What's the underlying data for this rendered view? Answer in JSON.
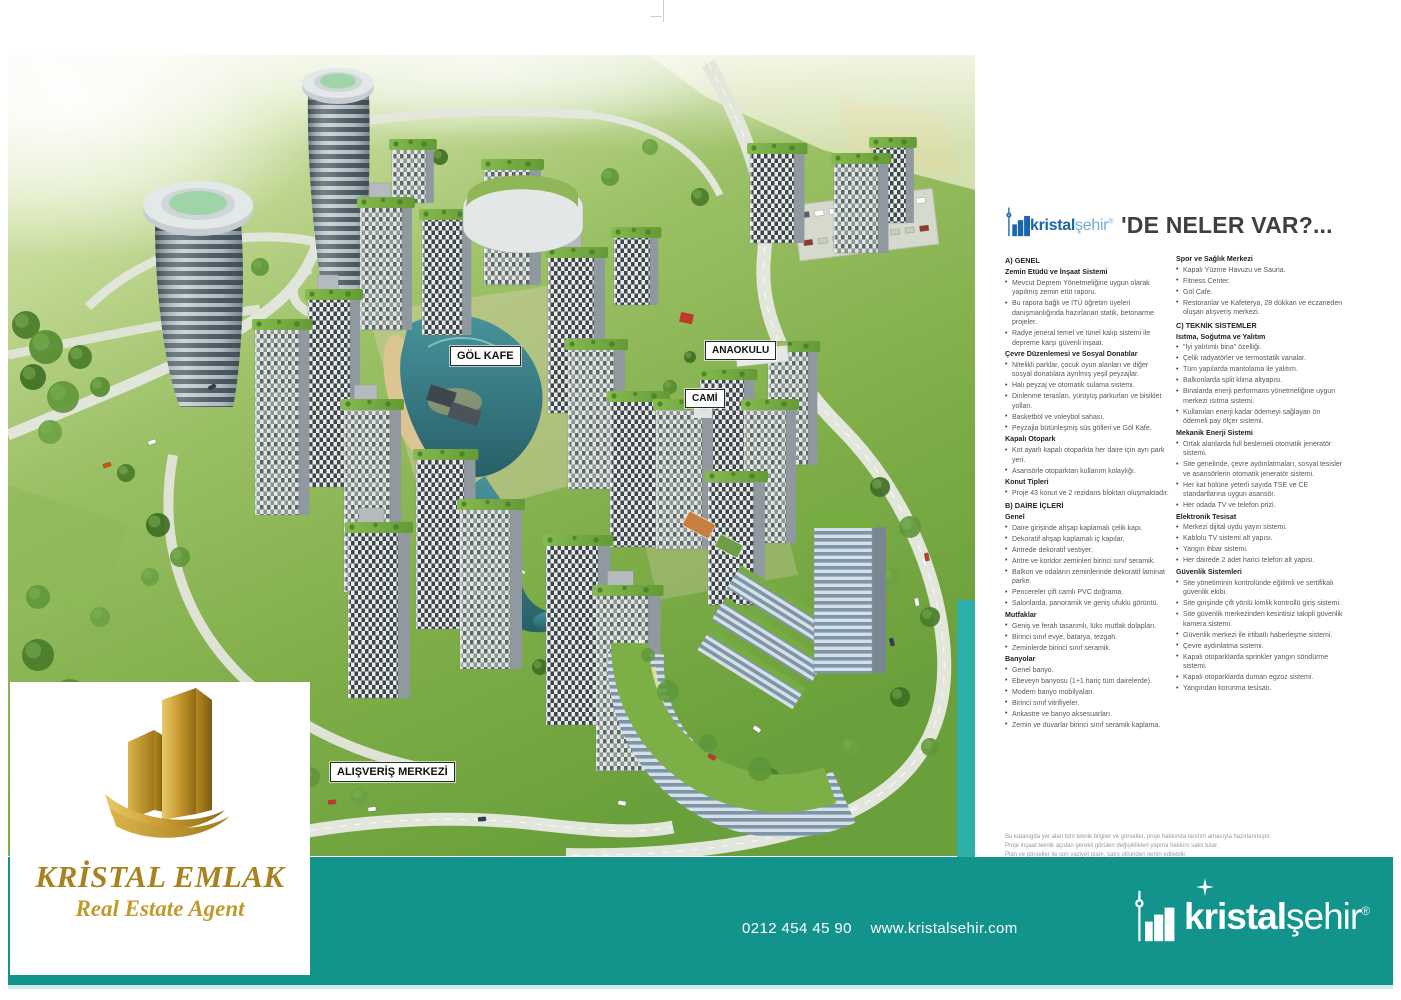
{
  "header": {
    "brand_bold": "kristal",
    "brand_light": "şehir",
    "reg": "®",
    "title": "'DE NELER VAR?..."
  },
  "map_labels": {
    "gol_kafe": "GÖL KAFE",
    "anaokulu": "ANAOKULU",
    "cami": "CAMİ",
    "avm": "ALIŞVERİŞ MERKEZİ"
  },
  "panel": {
    "columns": [
      {
        "sections": [
          {
            "heading": "A) GENEL",
            "kind": "maj",
            "bullets": []
          },
          {
            "heading": "Zemin Etüdü ve İnşaat Sistemi",
            "kind": "sub",
            "bullets": [
              "Mevcut Deprem Yönetmeliğine uygun olarak yapılmış zemin etüt raporu.",
              "Bu rapora bağlı ve İTÜ öğretim üyeleri danışmanlığında hazırlanan statik, betonarme projeler.",
              "Radye jeneral temel ve tünel kalıp sistemi ile depreme karşı güvenli inşaat."
            ]
          },
          {
            "heading": "Çevre Düzenlemesi ve Sosyal Donatılar",
            "kind": "sub",
            "bullets": [
              "Nitelikli parklar, çocuk oyun alanları ve diğer sosyal donatılara ayrılmış yeşil peyzajlar.",
              "Halı peyzaj ve otomatik sulama sistemi.",
              "Dinlenme terasları, yürüyüş parkurları ve bisiklet yolları.",
              "Basketbol ve voleybol sahası.",
              "Peyzajla bütünleşmiş süs gölleri ve Göl Kafe."
            ]
          },
          {
            "heading": "Kapalı Otopark",
            "kind": "sub",
            "bullets": [
              "Kot ayarlı kapalı otoparkta her daire için ayrı park yeri.",
              "Asansörle otoparktan kullanım kolaylığı."
            ]
          },
          {
            "heading": "Konut Tipleri",
            "kind": "sub",
            "bullets": [
              "Proje 43 konut ve 2 rezidans bloktan oluşmaktadır."
            ]
          },
          {
            "heading": "B) DAİRE İÇLERİ",
            "kind": "maj",
            "bullets": []
          },
          {
            "heading": "Genel",
            "kind": "sub",
            "bullets": [
              "Daire girişinde ahşap kaplamalı çelik kapı.",
              "Dekoratif ahşap kaplamalı iç kapılar.",
              "Antrede dekoratif vestiyer.",
              "Antre ve koridor zeminleri birinci sınıf seramik.",
              "Balkon ve odaların zeminlerinde dekoratif laminat parke.",
              "Pencereler çift camlı PVC doğrama.",
              "Salonlarda, panoramik ve geniş ufuklu görüntü."
            ]
          },
          {
            "heading": "Mutfaklar",
            "kind": "sub",
            "bullets": [
              "Geniş ve ferah tasarımlı, lüks mutfak dolapları.",
              "Birinci sınıf evye, batarya, tezgah.",
              "Zeminlerde birinci sınıf seramik."
            ]
          },
          {
            "heading": "Banyolar",
            "kind": "sub",
            "bullets": [
              "Genel banyo.",
              "Ebeveyn banyosu (1+1 hariç tüm dairelerde).",
              "Modern banyo mobilyaları.",
              "Birinci sınıf vitrifiyeler.",
              "Ankastre ve banyo aksesuarları.",
              "Zemin ve duvarlar birinci sınıf seramik kaplama."
            ]
          }
        ]
      },
      {
        "sections": [
          {
            "heading": "Spor ve Sağlık Merkezi",
            "kind": "sub",
            "bullets": [
              "Kapalı Yüzme Havuzu ve Sauna.",
              "Fitness Center.",
              "Göl Cafe.",
              "Restoranlar ve Kafeterya, 28 dükkan ve eczaneden oluşan alışveriş merkezi."
            ]
          },
          {
            "heading": "C) TEKNİK SİSTEMLER",
            "kind": "maj",
            "bullets": []
          },
          {
            "heading": "Isıtma, Soğutma ve Yalıtım",
            "kind": "sub",
            "bullets": [
              "\"İyi yalıtımlı bina\" özelliği.",
              "Çelik radyatörler ve termostatik vanalar.",
              "Tüm yapılarda mantolama ile yalıtım.",
              "Balkonlarda split klima altyapısı.",
              "Binalarda enerji performans yönetmeliğine uygun merkezi ısıtma sistemi.",
              "Kullanılan enerji kadar ödemeyi sağlayan ön ödemeli pay ölçer sistemi."
            ]
          },
          {
            "heading": "Mekanik Enerji Sistemi",
            "kind": "sub",
            "bullets": [
              "Ortak alanlarda full beslemeli otomatik jeneratör sistemi.",
              "Site genelinde, çevre aydınlatmaları, sosyal tesisler ve asansörlerin otomatik jeneratör sistemi.",
              "Her kat holüne yeterli sayıda TSE ve CE standartlarına uygun asansör.",
              "Her odada TV ve telefon prizi."
            ]
          },
          {
            "heading": "Elektronik Tesisat",
            "kind": "sub",
            "bullets": [
              "Merkezi dijital uydu yayın sistemi.",
              "Kablolu TV sistemi alt yapısı.",
              "Yangın ihbar sistemi.",
              "Her dairede 2 adet harici telefon alt yapısı."
            ]
          },
          {
            "heading": "Güvenlik Sistemleri",
            "kind": "sub",
            "bullets": [
              "Site yönetiminin kontrolünde eğitimli ve sertifikalı güvenlik ekibi.",
              "Site girişinde çift yönlü kimlik kontrollü giriş sistemi.",
              "Site güvenlik merkezinden kesintisiz takipli güvenlik kamera sistemi.",
              "Güvenlik merkezi ile irtibatlı haberleşme sistemi.",
              "Çevre aydınlatma sistemi.",
              "Kapalı otoparklarda sprinkler yangın söndürme sistemi.",
              "Kapalı otoparklarda duman egzoz sistemi.",
              "Yangından korunma tesisatı."
            ]
          }
        ]
      }
    ],
    "disclaimer_lines": [
      "Bu katalogda yer alan tüm teknik bilgiler ve görseller, proje hakkında tanıtım amacıyla hazırlanmıştır.",
      "Proje inşaat teknik açıdan gerekli görülen değişiklikleri yapma hakkını saklı tutar.",
      "Plan ve görseller ile son vaziyet planı, satış ofisinden temin edilebilir."
    ]
  },
  "footer": {
    "phone": "0212 454 45 90",
    "website": "www.kristalsehir.com",
    "brand_bold": "kristal",
    "brand_light": "şehir",
    "reg": "®"
  },
  "agent": {
    "name": "KRİSTAL EMLAK",
    "tagline": "Real Estate Agent"
  },
  "colors": {
    "teal_bar": "#12948d",
    "brand_blue": "#1a66ae",
    "gold": "#a8821e"
  }
}
